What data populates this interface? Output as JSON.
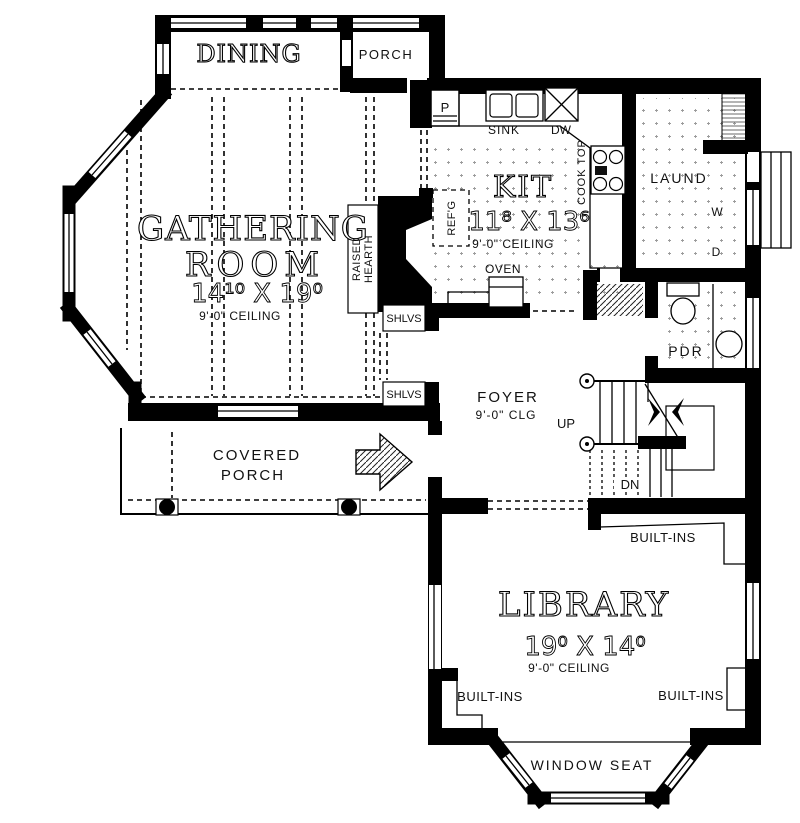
{
  "rooms": {
    "dining": {
      "label": "DINING"
    },
    "porch": {
      "label": "PORCH"
    },
    "gathering_room": {
      "line1": "GATHERING",
      "line2": "ROOM",
      "dimensions": "14¹⁰ X 19⁰",
      "ceiling": "9'-0\" CEILING"
    },
    "kitchen": {
      "label": "KIT",
      "dimensions": "11⁸ X 13⁶",
      "ceiling": "9'-0\" CEILING"
    },
    "laundry": {
      "label": "LAUND",
      "washer": "W",
      "dryer": "D"
    },
    "powder_room": {
      "label": "PDR"
    },
    "foyer": {
      "label": "FOYER",
      "ceiling": "9'-0\" CLG",
      "up": "UP",
      "down": "DN"
    },
    "covered_porch": {
      "line1": "COVERED",
      "line2": "PORCH"
    },
    "library": {
      "label": "LIBRARY",
      "dimensions": "19⁰ X 14⁰",
      "ceiling": "9'-0\" CEILING"
    },
    "window_seat": {
      "label": "WINDOW SEAT"
    }
  },
  "fixtures": {
    "pantry": "P",
    "sink": "SINK",
    "dishwasher": "DW",
    "cooktop": "COOK TOP",
    "refrigerator": "REF'G",
    "oven": "OVEN",
    "raised_hearth": {
      "line1": "RAISED",
      "line2": "HEARTH"
    },
    "shelves": [
      "SHLVS",
      "SHLVS"
    ],
    "built_ins": [
      "BUILT-INS",
      "BUILT-INS",
      "BUILT-INS"
    ]
  },
  "colors": {
    "wall": "#000000",
    "paper": "#ffffff"
  }
}
